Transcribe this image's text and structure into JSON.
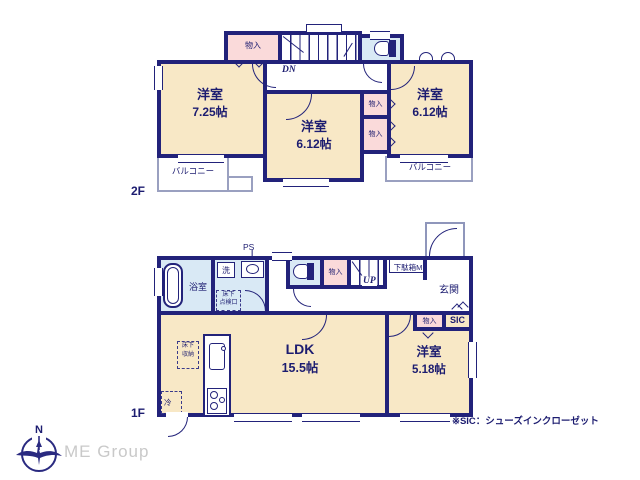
{
  "floor2": {
    "label": "2F",
    "room_left": {
      "name": "洋室",
      "size": "7.25帖"
    },
    "room_mid": {
      "name": "洋室",
      "size": "6.12帖"
    },
    "room_right": {
      "name": "洋室",
      "size": "6.12帖"
    },
    "closet_top": "物入",
    "closet_a": "物入",
    "closet_b": "物入",
    "stairs_label": "DN",
    "balcony_left": "バルコニー",
    "balcony_right": "バルコニー"
  },
  "floor1": {
    "label": "1F",
    "ldk": {
      "name": "LDK",
      "size": "15.5帖"
    },
    "bedroom": {
      "name": "洋室",
      "size": "5.18帖"
    },
    "bath": "浴室",
    "laundry": "洗",
    "ps": "PS",
    "hatch_line1": "床下",
    "hatch_line2": "点検口",
    "storage_line1": "床下",
    "storage_line2": "収納",
    "fridge": "冷",
    "closet_hall": "物入",
    "stairs_label": "UP",
    "shoe_cabinet": "下駄箱M",
    "entrance": "玄関",
    "closet_bedroom": "物入",
    "sic": "SIC"
  },
  "footer": {
    "note": "※SIC：シューズインクローゼット",
    "brand": "ME Group",
    "compass_north": "N"
  },
  "colors": {
    "wall": "#22227a",
    "room_fill": "#f8e8c6",
    "closet_fill": "#fadada",
    "wet_fill": "#d9e9f5",
    "outline_thin": "#9aa0c0",
    "brand_gray": "#c9c9c9"
  }
}
